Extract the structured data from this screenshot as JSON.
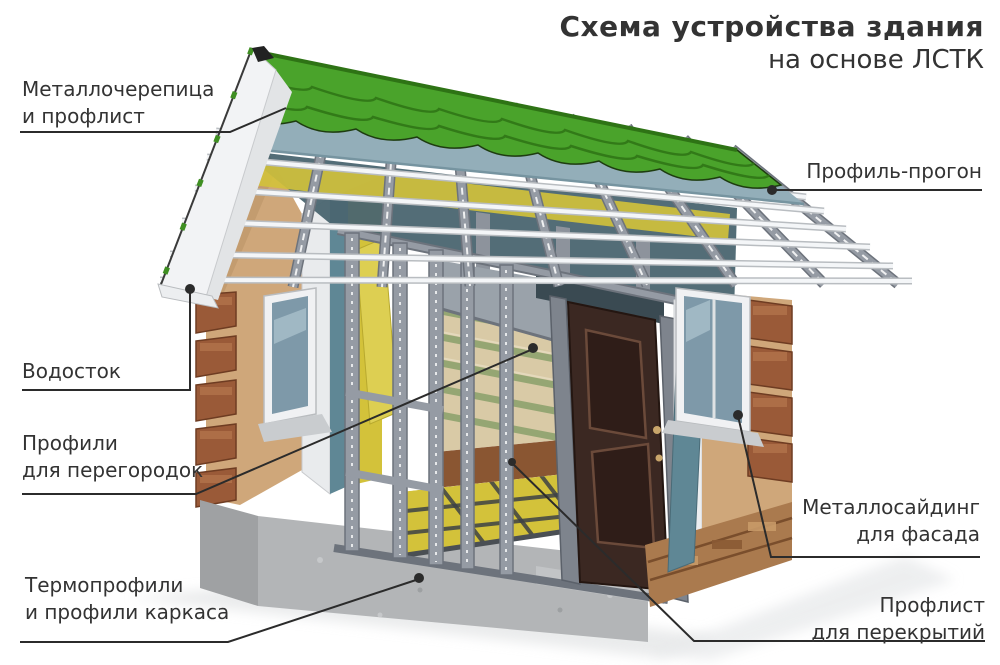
{
  "title": {
    "line1": "Схема устройства здания",
    "line2": "на основе ЛСТК"
  },
  "callouts": {
    "roofing": {
      "line1": "Металлочерепица",
      "line2": "и профлист"
    },
    "purlin": {
      "line1": "Профиль-прогон"
    },
    "gutter": {
      "line1": "Водосток"
    },
    "partition": {
      "line1": "Профили",
      "line2": "для перегородок"
    },
    "frame": {
      "line1": "Термопрофили",
      "line2": "и профили каркаса"
    },
    "siding": {
      "line1": "Металлосайдинг",
      "line2": "для фасада"
    },
    "decking": {
      "line1": "Профлист",
      "line2": "для перекрытий"
    }
  },
  "colors": {
    "background": "#ffffff",
    "text": "#333333",
    "callout_line": "#2b2b2b",
    "roof_green": "#4aa32b",
    "roof_green_dark": "#2e7315",
    "membrane_teal": "#93aeb9",
    "purlin_white": "#f4f6f8",
    "steel_gray": "#959ba4",
    "steel_dark": "#6d737c",
    "insulation_yellow": "#d3c23a",
    "stucco_tan": "#cfa77a",
    "brick_brown": "#9a5a38",
    "stone_brown": "#aa7a4e",
    "concrete_gray": "#b3b5b7",
    "door_brown": "#3b2822",
    "glass_blue": "#7e99a9",
    "wallpaper_beige": "#d9caa6",
    "wallpaper_stripe": "#95a673",
    "floor_brown": "#8a5632",
    "fascia_white": "#f2f3f5",
    "interior_dark": "#4a6570"
  }
}
